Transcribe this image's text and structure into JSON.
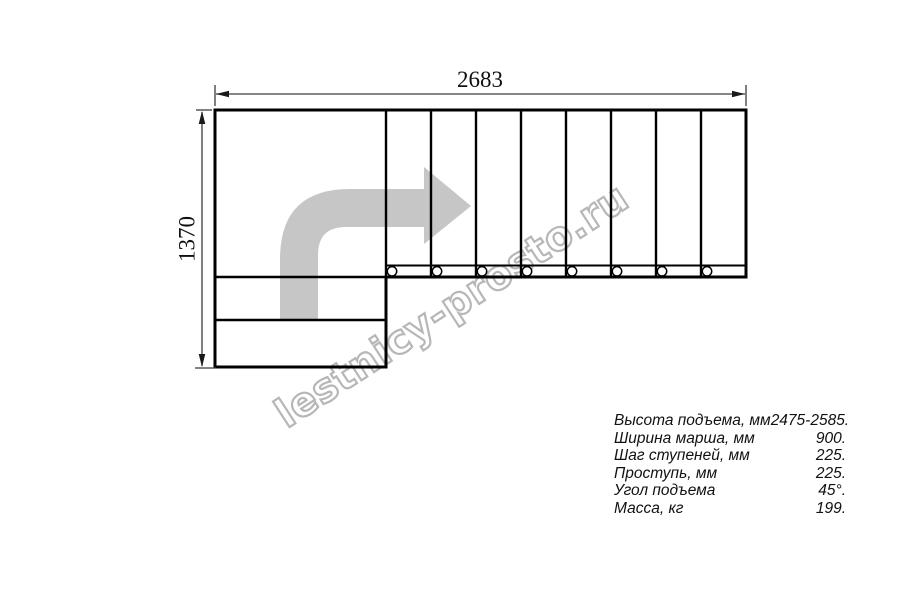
{
  "drawing": {
    "top_dimension_label": "2683",
    "left_dimension_label": "1370",
    "watermark_text": "lestnicy-prosto.ru",
    "stairs": {
      "upper_tread_count": 8,
      "lower_step_count": 2,
      "support_hole_count": 8,
      "travel_direction": "up-then-right"
    }
  },
  "specs": {
    "rows": [
      {
        "label": "Высота подъема, мм",
        "value": "2475-2585."
      },
      {
        "label": "Ширина марша, мм",
        "value": "900."
      },
      {
        "label": "Шаг ступеней, мм",
        "value": "225."
      },
      {
        "label": "Проступь, мм",
        "value": "225."
      },
      {
        "label": "Угол подъема",
        "value": "45°."
      },
      {
        "label": "Масса, кг",
        "value": "199."
      }
    ]
  },
  "colors": {
    "background": "#ffffff",
    "outline": "#000000",
    "dimension_line": "#3c3c3c",
    "arrow_fill": "#c6c6c6",
    "watermark_stroke": "#b7b7b7",
    "text": "#111111"
  }
}
